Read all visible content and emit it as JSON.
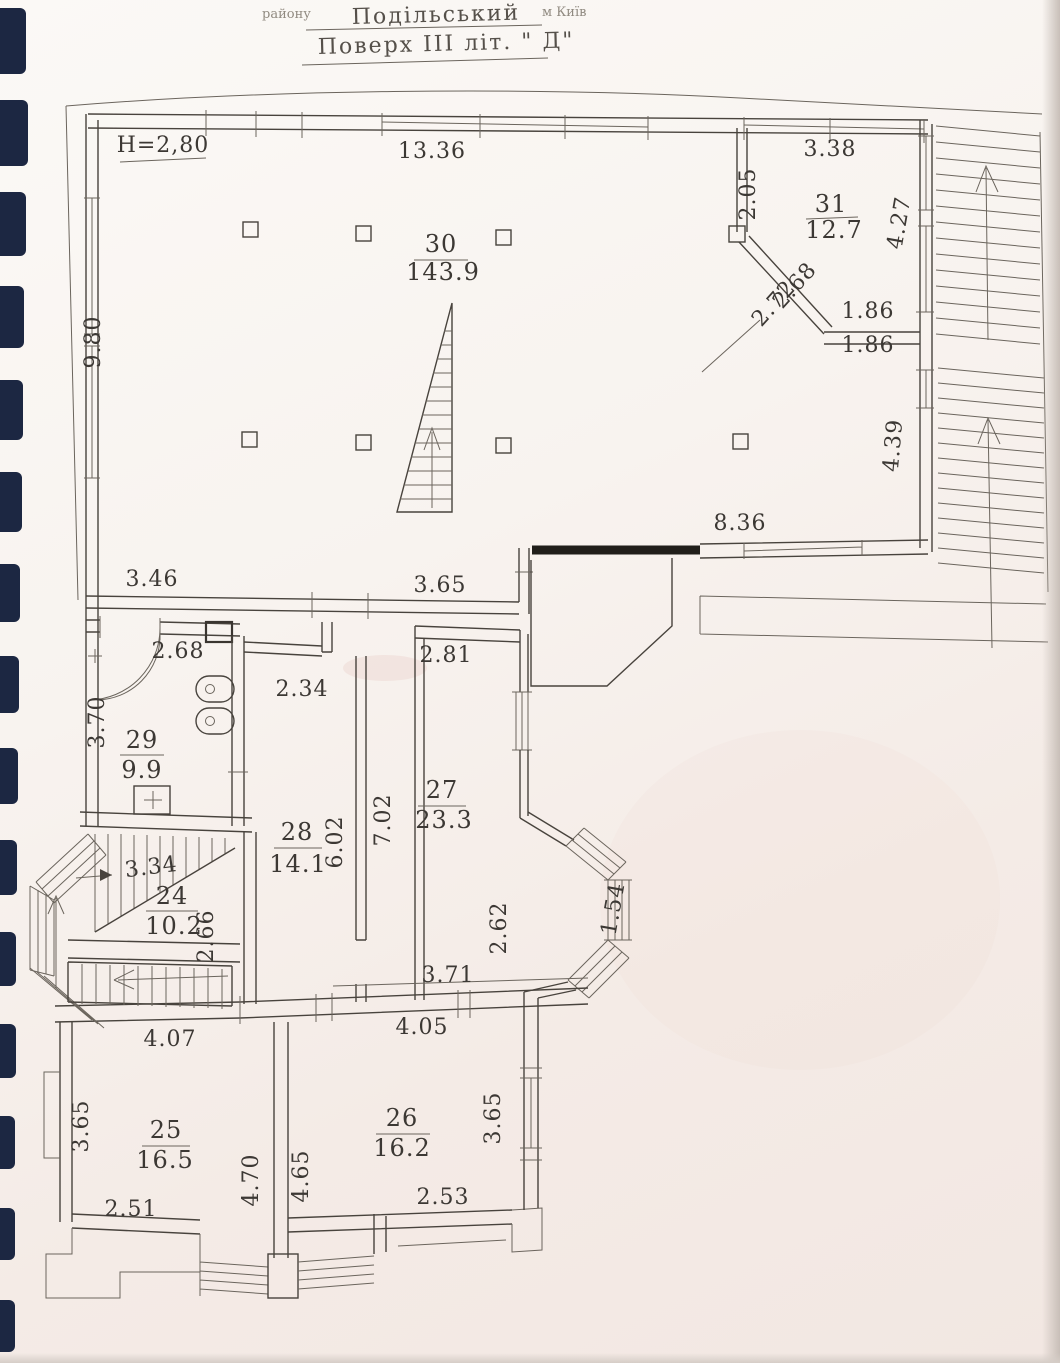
{
  "header": {
    "raion_label": "району",
    "raion_value": "Подільський",
    "city": "м Київ",
    "floor_title": "Поверх  III  літ. \" Д\""
  },
  "plan": {
    "ceiling_height": "H=2,80",
    "rooms": [
      {
        "number": "24",
        "area": "10.2"
      },
      {
        "number": "25",
        "area": "16.5"
      },
      {
        "number": "26",
        "area": "16.2"
      },
      {
        "number": "27",
        "area": "23.3"
      },
      {
        "number": "28",
        "area": "14.1"
      },
      {
        "number": "29",
        "area": "9.9"
      },
      {
        "number": "30",
        "area": "143.9"
      },
      {
        "number": "31",
        "area": "12.7"
      }
    ],
    "dimensions": {
      "top_main": "13.36",
      "top_right": "3.38",
      "r31_left": "2.05",
      "r31_right": "4.27",
      "r31_diag_outer": "2.68",
      "r31_diag_inner": "2.72",
      "r31_bottom_above": "1.86",
      "r31_bottom_below": "1.86",
      "left_wall": "9.80",
      "right_wall_lower": "4.39",
      "r30_bottom_right": "8.36",
      "r30_bottom_left": "3.46",
      "r30_bottom_mid": "3.65",
      "r29_top": "2.68",
      "r29_left": "3.70",
      "hall_door": "2.34",
      "r27_top": "2.81",
      "r28_height": "6.02",
      "r27_height": "7.02",
      "stair_flight": "3.34",
      "r24_right": "2.66",
      "r27_inner_right": "2.62",
      "bay_side": "1.54",
      "r27_bottom": "3.71",
      "r26_top": "4.05",
      "r25_top": "4.07",
      "r25_left": "3.65",
      "r25_bottom": "2.51",
      "partition_left": "4.70",
      "partition_right": "4.65",
      "r26_right": "3.65",
      "r26_bottom": "2.53"
    }
  }
}
